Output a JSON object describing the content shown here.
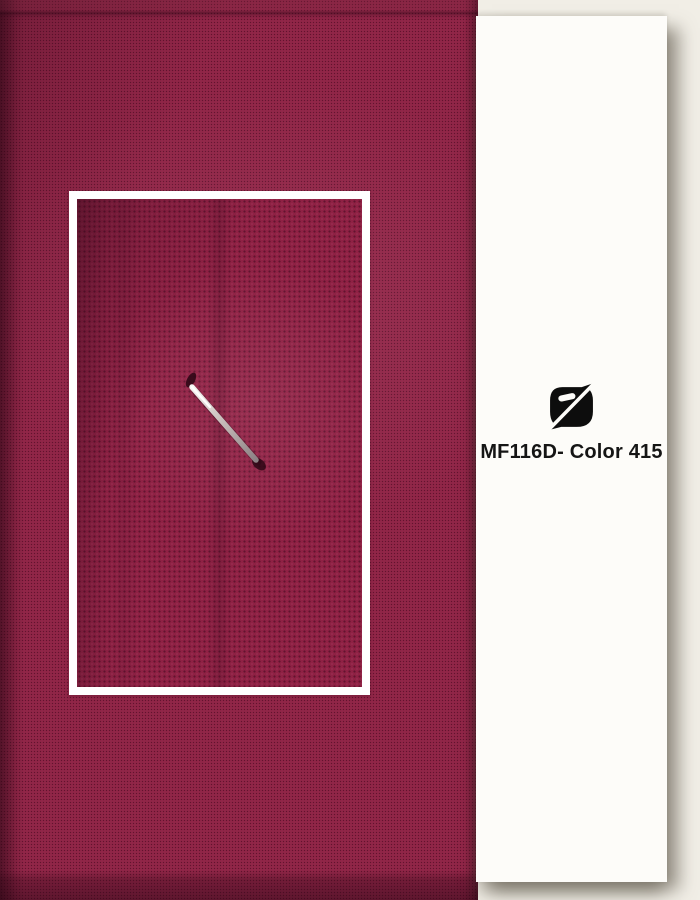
{
  "fabric_photo": {
    "description": "maroon woven fabric swatch",
    "base_color": "#8e2345",
    "weave_shadow_color": "#5a142e",
    "inset": {
      "description": "zoomed fabric close-up with metal pin",
      "frame_color": "#ffffff",
      "pin_color": "#c9bfbc"
    }
  },
  "info_panel": {
    "background_color": "#f1eee6",
    "card_color": "#fdfcf9",
    "logo_icon": "brand-monogram-icon",
    "logo_color": "#0d0d0d",
    "product_label": "MF116D- Color 415",
    "label_color": "#151515"
  }
}
